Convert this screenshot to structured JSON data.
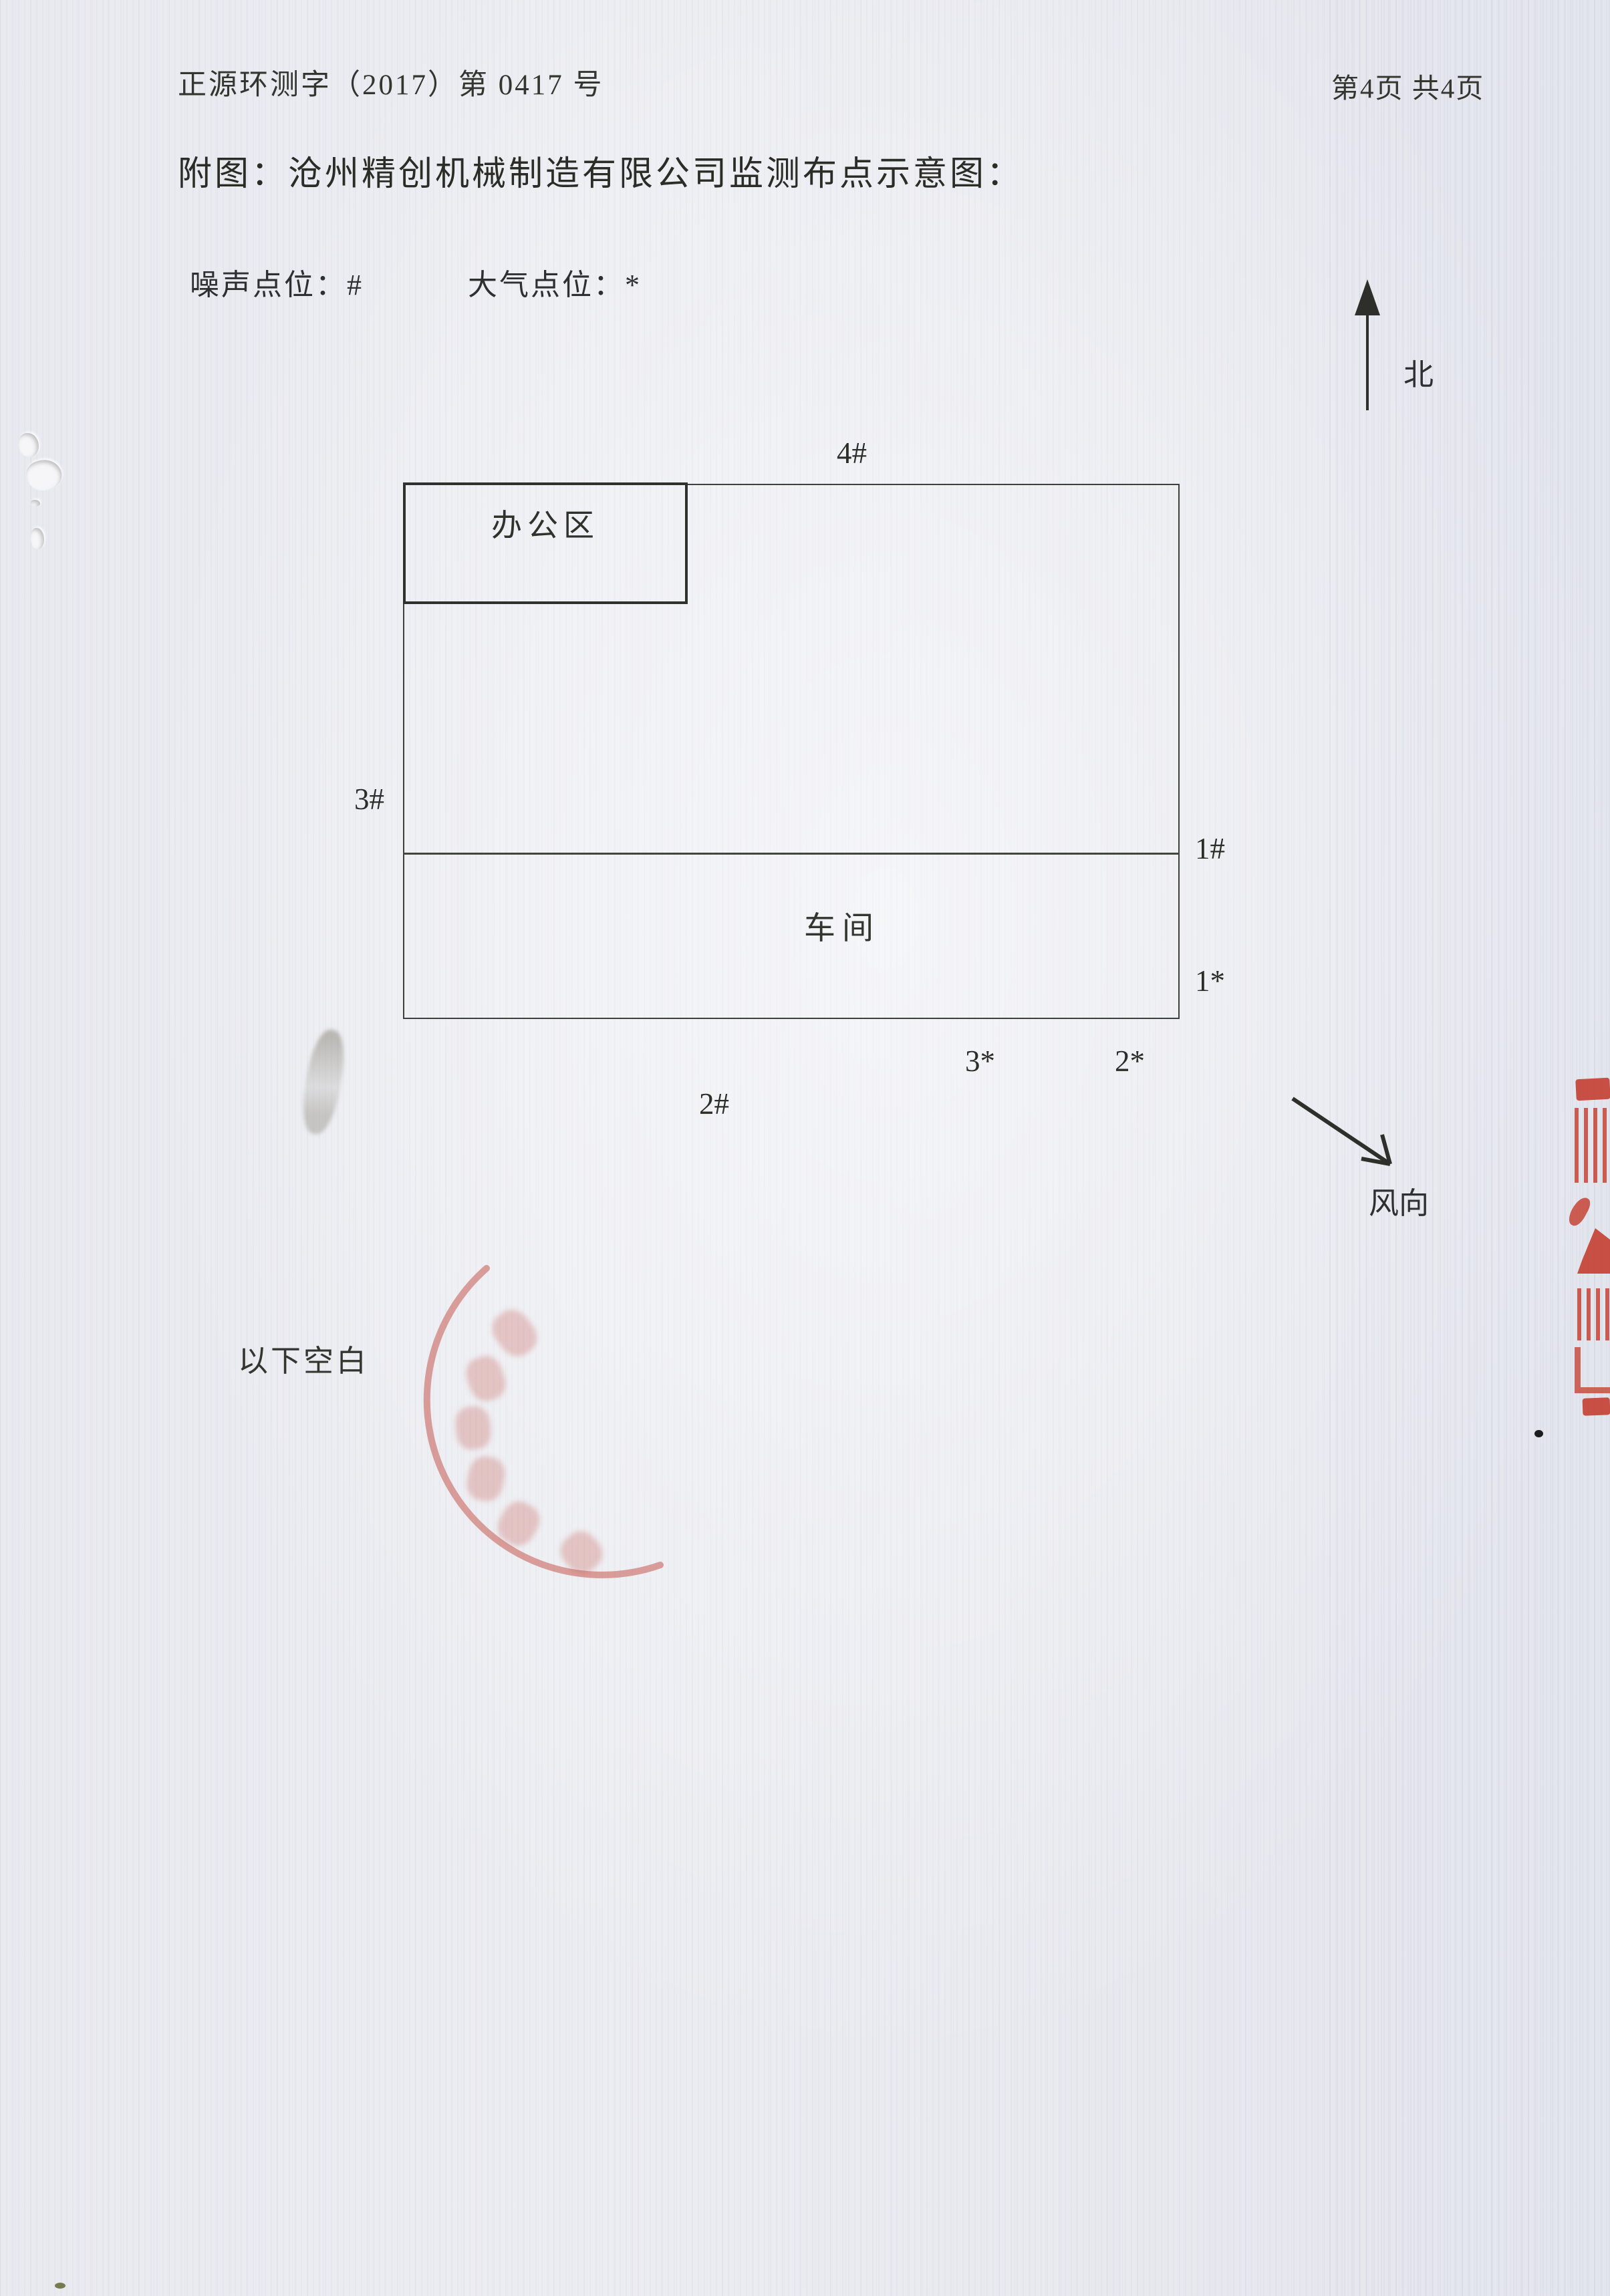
{
  "header": {
    "doc_number": "正源环测字（2017）第 0417 号",
    "page_indicator": "第4页 共4页"
  },
  "title": "附图：沧州精创机械制造有限公司监测布点示意图：",
  "legend": {
    "noise": "噪声点位：#",
    "air": "大气点位：*"
  },
  "compass": {
    "north_label": "北"
  },
  "wind": {
    "label": "风向"
  },
  "diagram": {
    "office_label": "办公区",
    "workshop_label": "车间",
    "point_labels": {
      "n4": "4#",
      "n3": "3#",
      "n1": "1#",
      "n2": "2#",
      "a1": "1*",
      "a2": "2*",
      "a3": "3*"
    }
  },
  "footer_note": "以下空白",
  "colors": {
    "ink": "#2e2f31",
    "paper": "#e9eaf0",
    "stamp_red": "#c33a2b",
    "stamp_faint_red": "#c75c52"
  }
}
